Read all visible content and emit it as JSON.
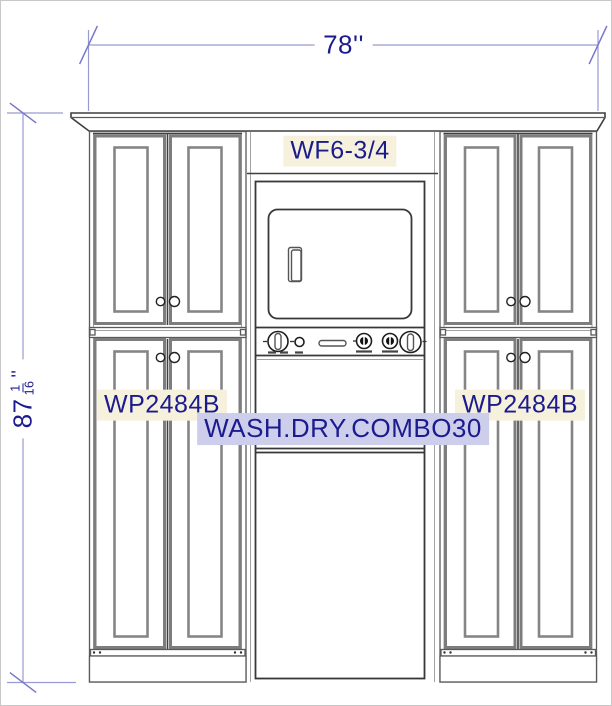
{
  "colors": {
    "dim_line": "#9a9ad2",
    "dim_tick": "#7878c8",
    "dim_text": "#1b1b8e",
    "label_text": "#1b1b8e",
    "cream_bg": "#f6f1dd",
    "lavender_bg": "#cdcdec",
    "canvas_border": "#c8c8c8"
  },
  "annotations": {
    "width_dim": "78''",
    "height_dim": {
      "whole": "87",
      "numerator": "1",
      "denominator": "16",
      "unit": "''"
    }
  },
  "labels": {
    "filler": "WF6-3/4",
    "left_cabinet": "WP2484B",
    "right_cabinet": "WP2484B",
    "appliance": "WASH.DRY.COMBO30"
  }
}
